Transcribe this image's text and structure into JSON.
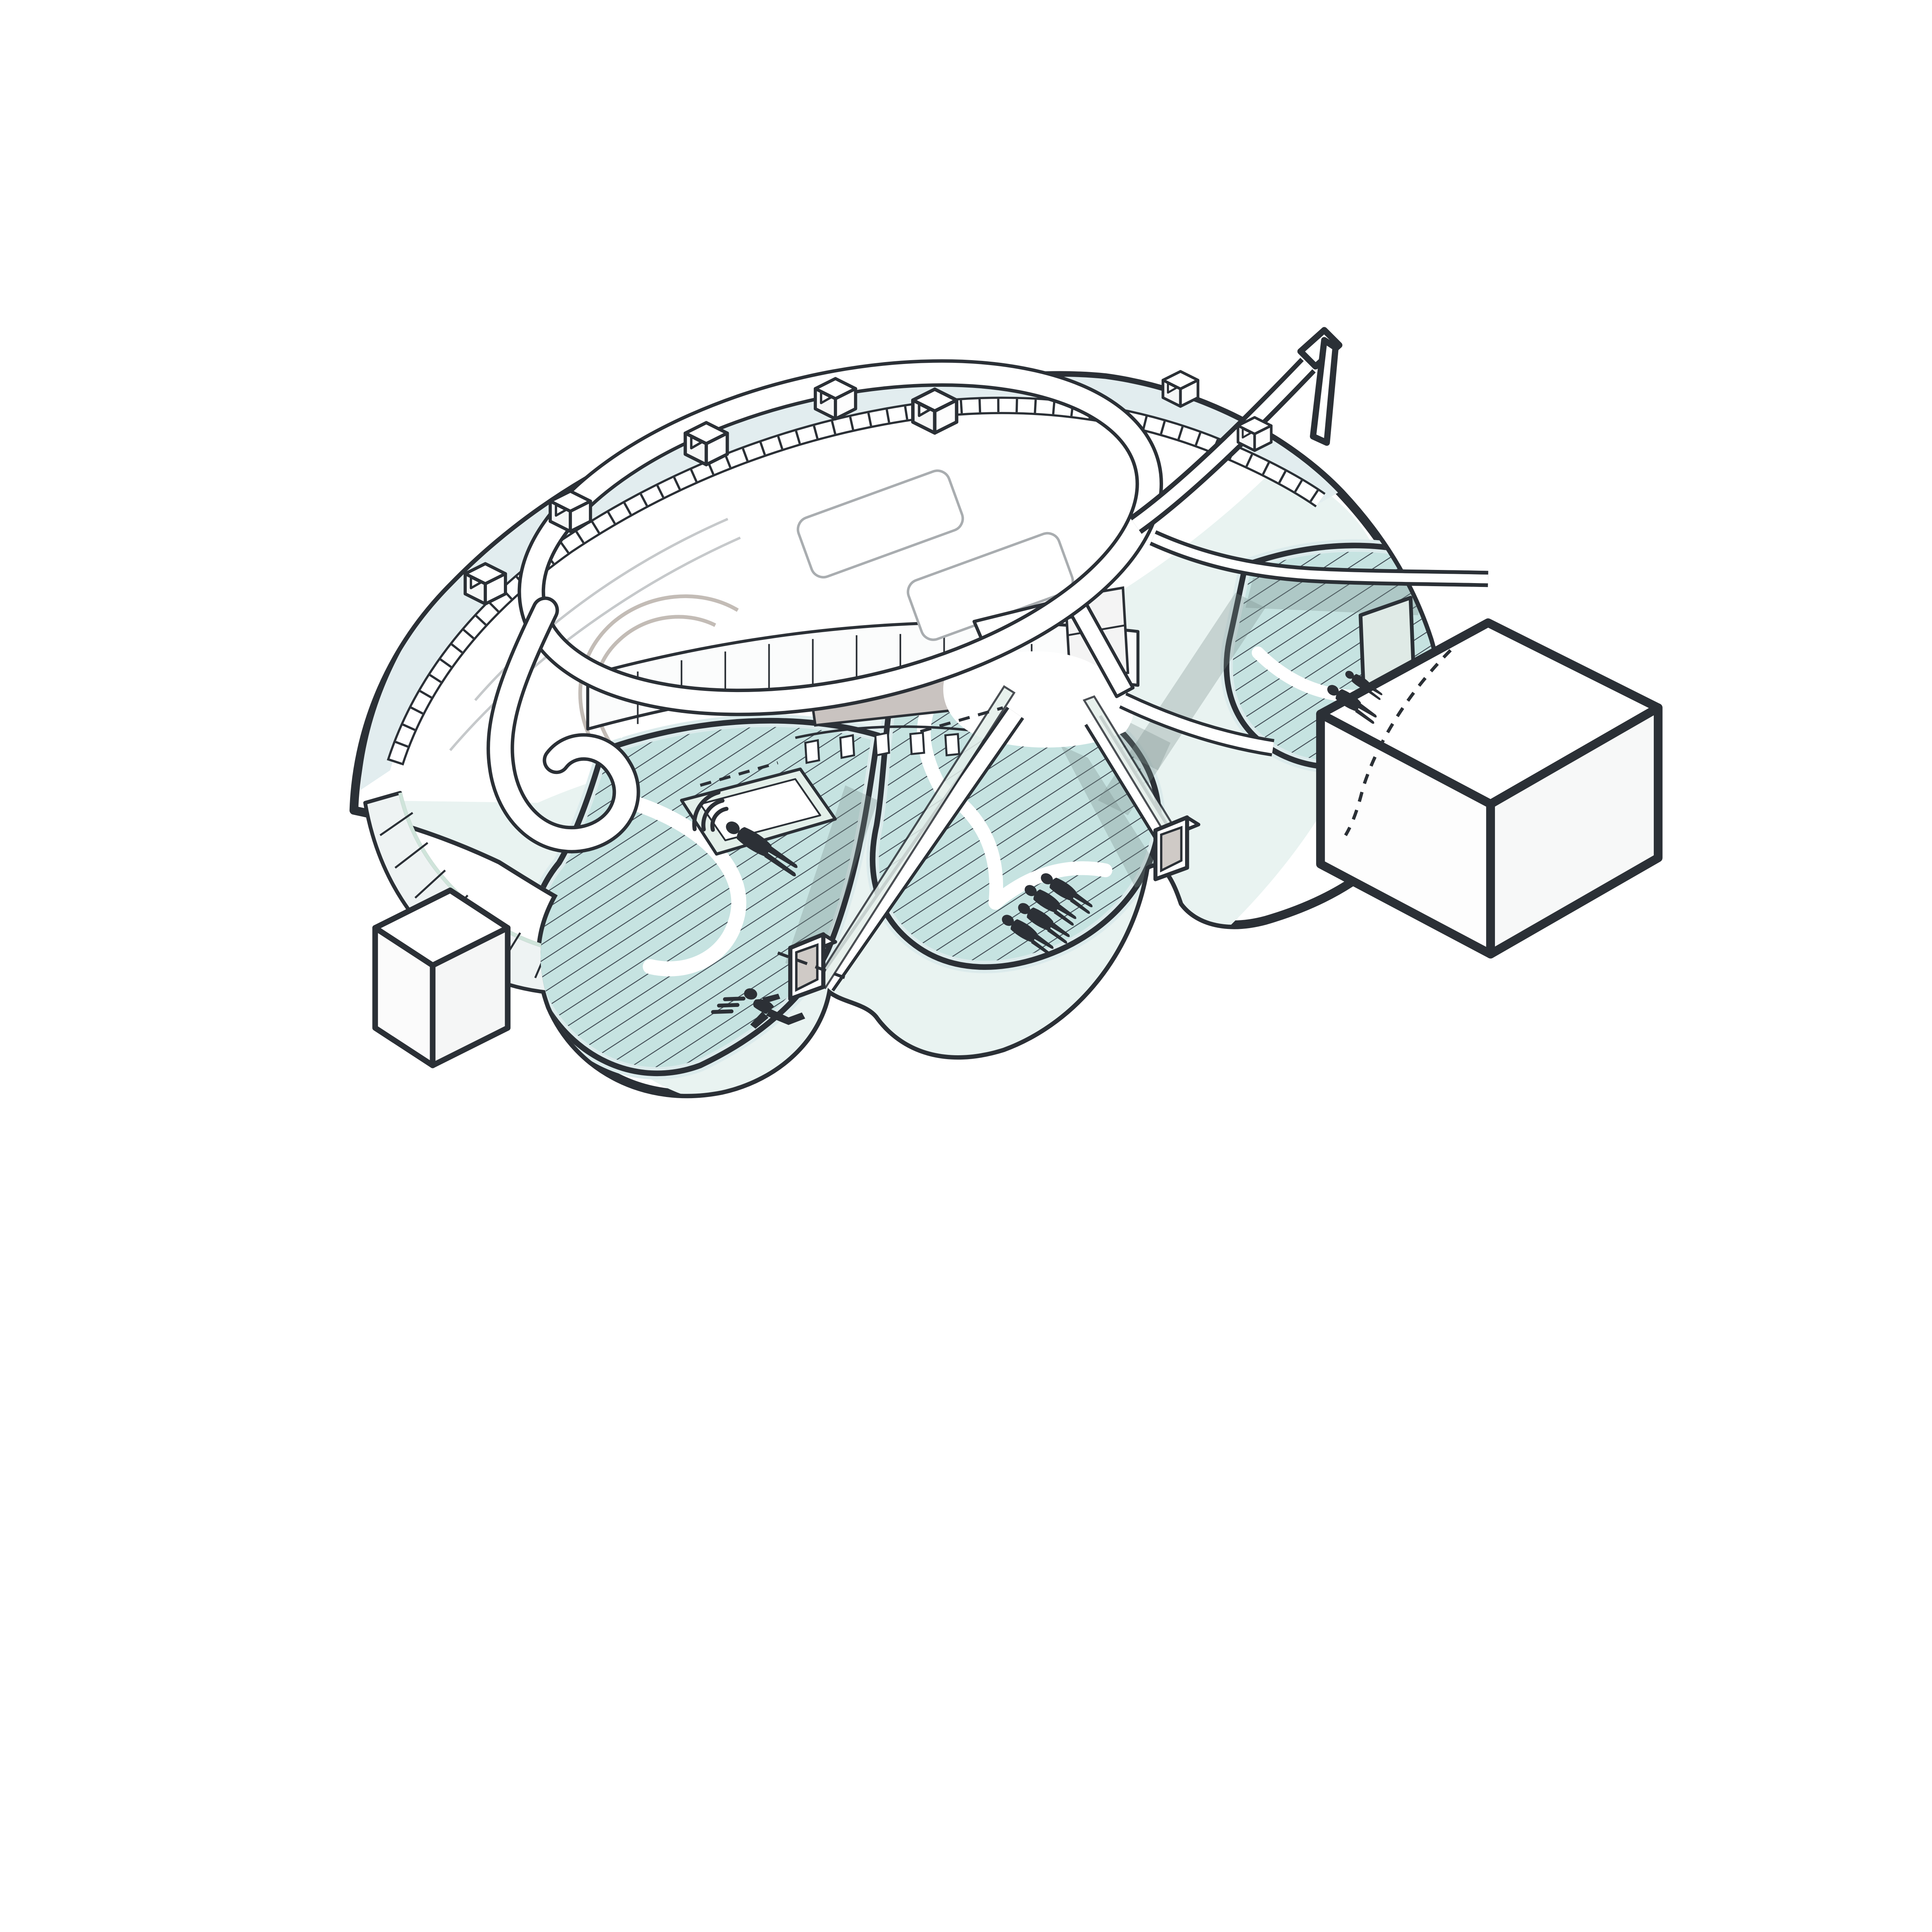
{
  "diagram": {
    "kind": "axonometric architectural diagram",
    "subject": "organic looped pavilion with lagoon pools, circulation ramp loop, bridges and portals",
    "background": "#ffffff"
  },
  "palette": {
    "outline": "#2b3036",
    "glass_roof": "#e2edef",
    "glass_panel": "#eef3f3",
    "deck": "#e9f3f1",
    "pool_fill": "#c6e3e1",
    "pool_hatch_line": "#46525a",
    "pool_rim": "#dcebec",
    "screen_gray": "#c9c3c0",
    "shadow": "rgba(120,140,136,0.30)",
    "figure": "#2c3036",
    "mint_edge": "#cfe4da",
    "paper": "#ffffff",
    "faint": "#c6c9cb"
  },
  "icons": [
    {
      "name": "floating-person-icon",
      "meaning": "person floating/lying with ripple waves",
      "count": 1
    },
    {
      "name": "family-group-icon",
      "meaning": "group of four standing figures",
      "count": 4
    },
    {
      "name": "parent-child-icon",
      "meaning": "adult with child",
      "count": 2
    },
    {
      "name": "running-person-icon",
      "meaning": "running figure with speed lines",
      "count": 1
    }
  ],
  "structures": {
    "skylight_boxes": 7,
    "hatched_pools": 3,
    "door_portals": 2,
    "white_pool_paths": 3,
    "large_white_volume": 1,
    "small_white_volume": 1,
    "circulation": "continuous white loop ramp with hairpin, oval ring, elevated walkway exits top-right and right"
  }
}
